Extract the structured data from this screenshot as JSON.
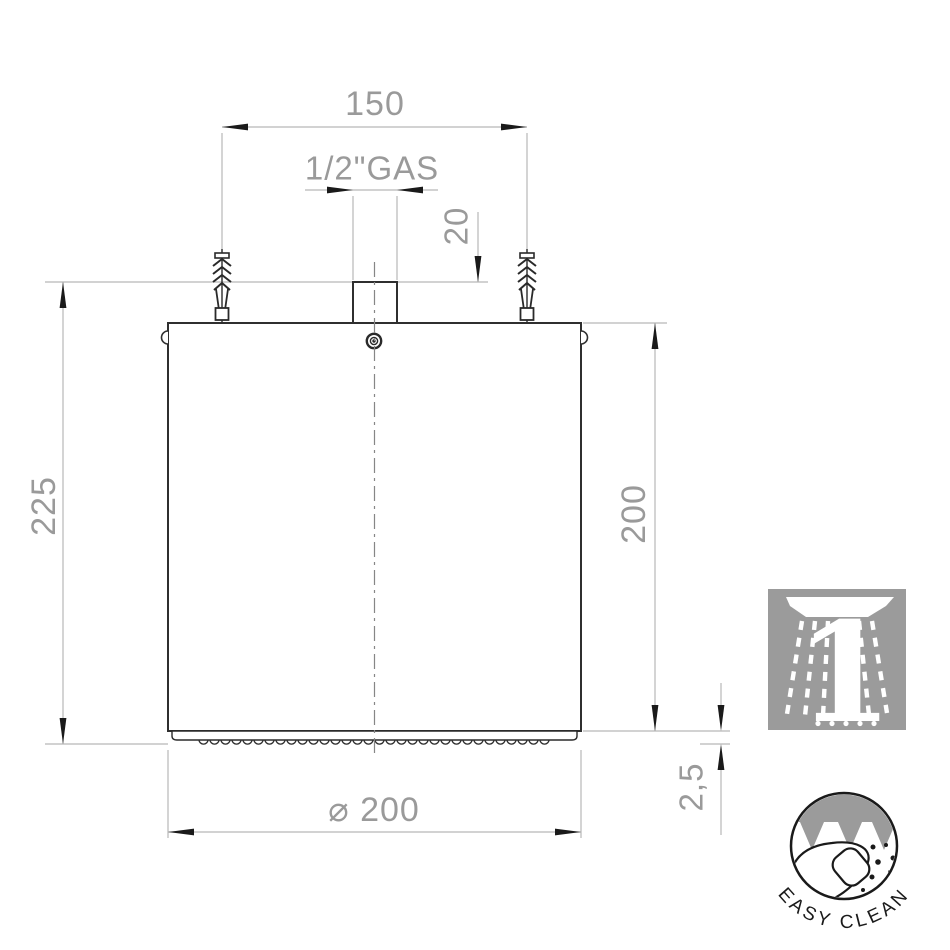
{
  "title": "Ceiling shower head installation drawing",
  "dimensions": {
    "mount_spacing": "150",
    "thread": "1/2\"GAS",
    "pipe_height": "20",
    "total_height": "225",
    "body_height": "200",
    "diameter": "⌀ 200",
    "nozzle_protrusion": "2,5"
  },
  "icons": {
    "spray_icon": {
      "name": "one-spray-function-icon",
      "count": "1"
    },
    "easy_clean": {
      "name": "easy-clean-badge",
      "label": "EASY CLEAN"
    }
  },
  "colors": {
    "outline_dark": "#2f2f2f",
    "dim_line_light": "#b8b8b8",
    "dim_text_gray": "#9a9a9a",
    "arrow_black": "#1a1a1a",
    "icon_gray": "#9b9b9b"
  }
}
